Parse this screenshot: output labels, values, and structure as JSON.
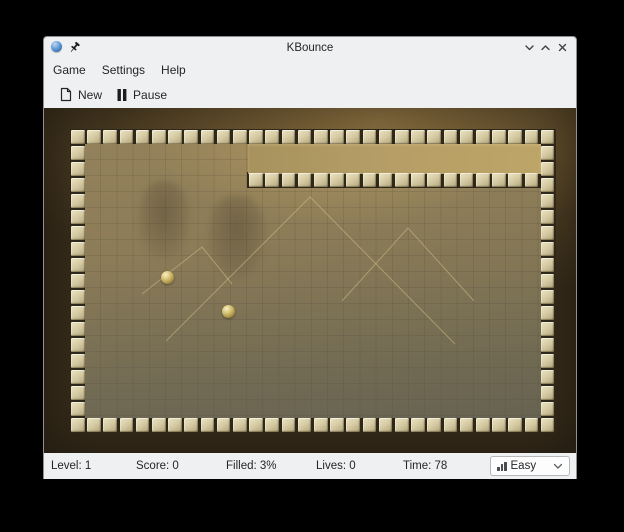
{
  "window": {
    "title": "KBounce"
  },
  "titlebar": {
    "app_icon": "kbounce-ball-icon",
    "pin_icon": "pin-icon",
    "buttons": {
      "minimize": "chevron-down",
      "maximize": "chevron-up",
      "close": "close-x"
    }
  },
  "menubar": {
    "items": [
      {
        "label": "Game"
      },
      {
        "label": "Settings"
      },
      {
        "label": "Help"
      }
    ]
  },
  "toolbar": {
    "new_label": "New",
    "pause_label": "Pause",
    "new_icon": "new-document-icon",
    "pause_icon": "pause-icon"
  },
  "statusbar": {
    "level": "Level: 1",
    "score": "Score: 0",
    "filled": "Filled: 3%",
    "lives": "Lives: 0",
    "time": "Time: 78",
    "difficulty_value": "Easy",
    "difficulty_icon": "difficulty-bars-icon"
  },
  "board": {
    "cols": 30,
    "rows": 19,
    "pitch_x": 16.2,
    "pitch_y": 16,
    "tile_w": 13.6,
    "tile_h": 13.5,
    "extra_wall_row": {
      "y": 44,
      "start_col": 11,
      "end_col": 28
    },
    "filled_region": {
      "left": 178,
      "top": 15,
      "width": 293,
      "height": 30
    },
    "balls": [
      {
        "x": 97,
        "y": 148,
        "r": 6.5
      },
      {
        "x": 158,
        "y": 182,
        "r": 6.5
      }
    ],
    "figures": [
      {
        "x": 68,
        "y": 52,
        "w": 52,
        "h": 78
      },
      {
        "x": 138,
        "y": 66,
        "w": 58,
        "h": 84
      }
    ],
    "pyramids": [
      "96,212 240,68 385,215",
      "72,165 132,118 162,155",
      "272,172 338,99 404,172"
    ]
  },
  "colors": {
    "chrome_bg": "#eff0f1",
    "text": "#232629",
    "frame_dark": "#3a2f1c",
    "frame_gold": "#8f7443",
    "tile_light": "#ece4c2",
    "tile_dark": "#b1a57c",
    "field_base": "#8c7c58",
    "filled_band": "#b59e66",
    "ball_gold": "#d8c27a",
    "pyramid_line": "rgba(216,196,140,0.5)",
    "app_icon_blue": "#2f6cb4"
  }
}
